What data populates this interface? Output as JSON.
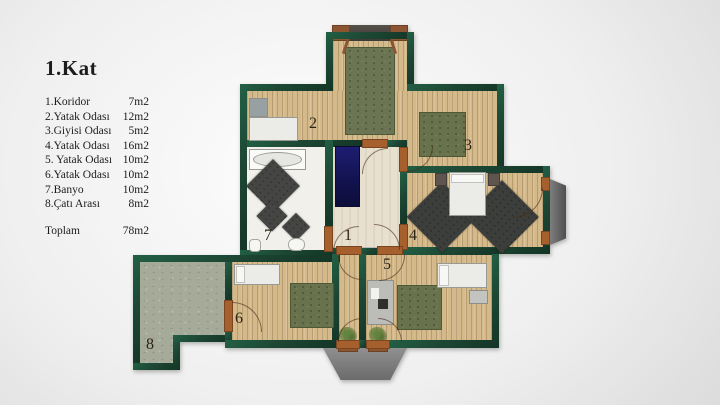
{
  "title": "1.Kat",
  "legend": {
    "rows": [
      {
        "number": "1",
        "label": "1.Koridor",
        "area": "7m2"
      },
      {
        "number": "2",
        "label": "2.Yatak Odası",
        "area": "12m2"
      },
      {
        "number": "3",
        "label": "3.Giyisi Odası",
        "area": "5m2"
      },
      {
        "number": "4",
        "label": "4.Yatak Odası",
        "area": "16m2"
      },
      {
        "number": "5",
        "label": "5. Yatak Odası",
        "area": "10m2"
      },
      {
        "number": "6",
        "label": "6.Yatak Odası",
        "area": "10m2"
      },
      {
        "number": "7",
        "label": "7.Banyo",
        "area": "10m2"
      },
      {
        "number": "8",
        "label": "8.Çatı Arası",
        "area": "8m2"
      }
    ],
    "total_label": "Toplam",
    "total_area": "78m2"
  },
  "colors": {
    "wall_green": "#1d4734",
    "wood_floor": "#d4b98b",
    "corridor_floor": "#e8e0cf",
    "bathroom_floor": "#f2f0ea",
    "attic_floor": "#a6ab99",
    "rug_green": "#68734d",
    "rug_navy": "#15155a",
    "rug_charcoal": "#3c3e3c",
    "door_frame": "#a6602e"
  }
}
